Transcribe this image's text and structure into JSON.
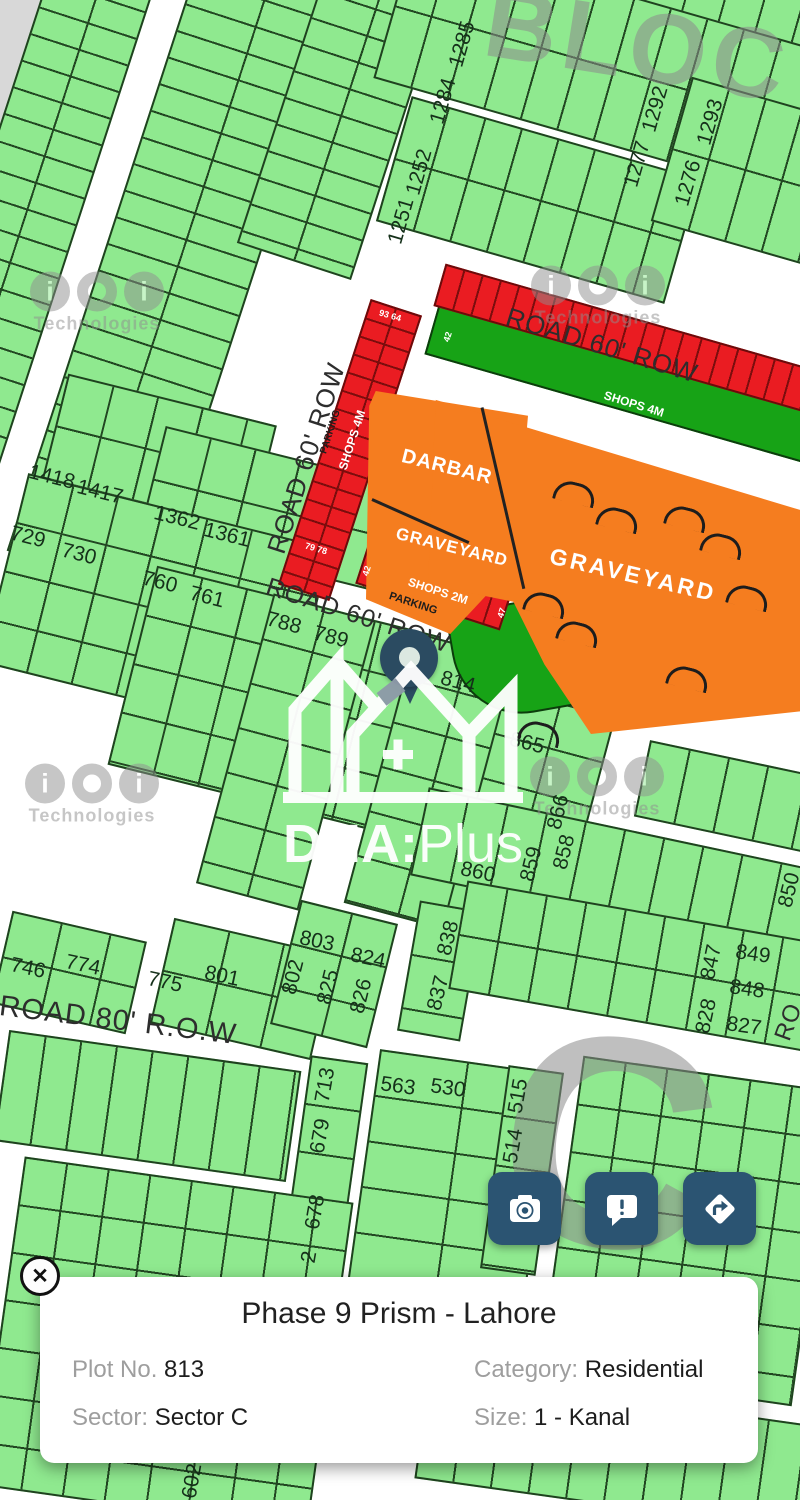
{
  "map": {
    "plots": [
      {
        "t": "1284",
        "x": 443,
        "y": 101,
        "r": -74
      },
      {
        "t": "1285",
        "x": 462,
        "y": 44,
        "r": -74
      },
      {
        "t": "1292",
        "x": 655,
        "y": 109,
        "r": -74
      },
      {
        "t": "1293",
        "x": 710,
        "y": 122,
        "r": -74
      },
      {
        "t": "1251",
        "x": 401,
        "y": 221,
        "r": -74
      },
      {
        "t": "1252",
        "x": 419,
        "y": 172,
        "r": -74
      },
      {
        "t": "1277",
        "x": 637,
        "y": 164,
        "r": -74
      },
      {
        "t": "1276",
        "x": 688,
        "y": 183,
        "r": -74
      },
      {
        "t": "1418",
        "x": 52,
        "y": 477,
        "r": 14
      },
      {
        "t": "1417",
        "x": 100,
        "y": 492,
        "r": 14
      },
      {
        "t": "1362",
        "x": 177,
        "y": 518,
        "r": 14
      },
      {
        "t": "1361",
        "x": 227,
        "y": 535,
        "r": 14
      },
      {
        "t": "729",
        "x": 28,
        "y": 537,
        "r": 14
      },
      {
        "t": "730",
        "x": 79,
        "y": 554,
        "r": 14
      },
      {
        "t": "760",
        "x": 160,
        "y": 582,
        "r": 14
      },
      {
        "t": "761",
        "x": 207,
        "y": 597,
        "r": 14
      },
      {
        "t": "788",
        "x": 284,
        "y": 623,
        "r": 15
      },
      {
        "t": "789",
        "x": 331,
        "y": 637,
        "r": 15
      },
      {
        "t": "813",
        "x": 404,
        "y": 668,
        "r": 15
      },
      {
        "t": "814",
        "x": 458,
        "y": 682,
        "r": 15
      },
      {
        "t": "865",
        "x": 527,
        "y": 743,
        "r": 14
      },
      {
        "t": "866",
        "x": 558,
        "y": 812,
        "r": -76
      },
      {
        "t": "860",
        "x": 478,
        "y": 872,
        "r": 12
      },
      {
        "t": "859",
        "x": 531,
        "y": 864,
        "r": -76
      },
      {
        "t": "858",
        "x": 564,
        "y": 852,
        "r": -76
      },
      {
        "t": "850",
        "x": 789,
        "y": 890,
        "r": -76
      },
      {
        "t": "838",
        "x": 448,
        "y": 938,
        "r": -76
      },
      {
        "t": "837",
        "x": 438,
        "y": 993,
        "r": -76
      },
      {
        "t": "803",
        "x": 317,
        "y": 941,
        "r": 12
      },
      {
        "t": "824",
        "x": 368,
        "y": 958,
        "r": 12
      },
      {
        "t": "802",
        "x": 293,
        "y": 977,
        "r": -76
      },
      {
        "t": "825",
        "x": 328,
        "y": 987,
        "r": -76
      },
      {
        "t": "826",
        "x": 361,
        "y": 996,
        "r": -76
      },
      {
        "t": "746",
        "x": 28,
        "y": 968,
        "r": 12
      },
      {
        "t": "774",
        "x": 83,
        "y": 965,
        "r": 12
      },
      {
        "t": "775",
        "x": 165,
        "y": 982,
        "r": 12
      },
      {
        "t": "801",
        "x": 222,
        "y": 976,
        "r": 12
      },
      {
        "t": "847",
        "x": 711,
        "y": 962,
        "r": -78
      },
      {
        "t": "849",
        "x": 753,
        "y": 954,
        "r": 8
      },
      {
        "t": "848",
        "x": 747,
        "y": 989,
        "r": 8
      },
      {
        "t": "828",
        "x": 706,
        "y": 1016,
        "r": -78
      },
      {
        "t": "827",
        "x": 744,
        "y": 1026,
        "r": 8
      },
      {
        "t": "713",
        "x": 325,
        "y": 1085,
        "r": -80
      },
      {
        "t": "679",
        "x": 320,
        "y": 1136,
        "r": -80
      },
      {
        "t": "563",
        "x": 398,
        "y": 1086,
        "r": 8
      },
      {
        "t": "530",
        "x": 448,
        "y": 1088,
        "r": 8
      },
      {
        "t": "515",
        "x": 518,
        "y": 1096,
        "r": -80
      },
      {
        "t": "514",
        "x": 513,
        "y": 1146,
        "r": -80
      },
      {
        "t": "678",
        "x": 315,
        "y": 1212,
        "r": -80
      },
      {
        "t": "2",
        "x": 309,
        "y": 1257,
        "r": -80
      },
      {
        "t": "602",
        "x": 192,
        "y": 1481,
        "r": -80
      }
    ],
    "roads": [
      {
        "t": "ROAD 60' ROW",
        "x": 602,
        "y": 345,
        "r": 17,
        "s": 26
      },
      {
        "t": "ROAD 60' ROW",
        "x": 306,
        "y": 458,
        "r": -72,
        "s": 26
      },
      {
        "t": "ROAD 60' ROW",
        "x": 358,
        "y": 616,
        "r": 18,
        "s": 25
      },
      {
        "t": "ROAD 80' R.O.W",
        "x": 118,
        "y": 1021,
        "r": 7,
        "s": 29
      },
      {
        "t": "RO",
        "x": 789,
        "y": 1022,
        "r": -70,
        "s": 24
      }
    ],
    "areas": [
      {
        "t": "DARBAR",
        "x": 447,
        "y": 467,
        "r": 14,
        "s": 20,
        "ls": 1
      },
      {
        "t": "GRAVEYARD",
        "x": 452,
        "y": 547,
        "r": 14,
        "s": 17,
        "ls": 1
      },
      {
        "t": "GRAVEYARD",
        "x": 633,
        "y": 575,
        "r": 13,
        "s": 23,
        "ls": 3
      }
    ],
    "shop_labels": [
      {
        "t": "SHOPS 4M",
        "x": 352,
        "y": 440,
        "r": -72,
        "s": 12
      },
      {
        "t": "SHOPS 4M",
        "x": 634,
        "y": 404,
        "r": 17,
        "s": 12
      },
      {
        "t": "SHOPS 2M",
        "x": 438,
        "y": 591,
        "r": 18,
        "s": 12
      }
    ],
    "parking_labels": [
      {
        "t": "PARKING",
        "x": 331,
        "y": 432,
        "r": -72,
        "s": 10
      },
      {
        "t": "PARKING",
        "x": 413,
        "y": 604,
        "r": 18,
        "s": 11
      }
    ],
    "corner_numbers": [
      {
        "t": "93 64",
        "x": 390,
        "y": 316,
        "r": 16,
        "s": 9
      },
      {
        "t": "79 78",
        "x": 316,
        "y": 549,
        "r": 16,
        "s": 9
      },
      {
        "t": "42",
        "x": 448,
        "y": 337,
        "r": -72,
        "s": 9
      },
      {
        "t": "42",
        "x": 367,
        "y": 571,
        "r": -72,
        "s": 9
      },
      {
        "t": "47",
        "x": 502,
        "y": 613,
        "r": -72,
        "s": 9
      }
    ],
    "big_watermarks": [
      {
        "t": "BLOC",
        "x": 638,
        "y": 45,
        "r": 9,
        "s": 100
      },
      {
        "t": "C",
        "x": 612,
        "y": 1142,
        "r": 8,
        "s": 300
      }
    ],
    "brand_watermark": {
      "letters": [
        "i",
        "o",
        "i"
      ],
      "caption": "Technologies",
      "spots": [
        {
          "x": 97,
          "y": 303
        },
        {
          "x": 598,
          "y": 297
        },
        {
          "x": 92,
          "y": 795
        },
        {
          "x": 597,
          "y": 788
        }
      ]
    },
    "graveyard_arcs": [
      [
        575,
        493
      ],
      [
        618,
        519
      ],
      [
        686,
        518
      ],
      [
        722,
        545
      ],
      [
        545,
        604
      ],
      [
        578,
        633
      ],
      [
        688,
        678
      ],
      [
        748,
        597
      ],
      [
        540,
        733
      ]
    ]
  },
  "logo": {
    "bold": "DHA",
    "sep": ":",
    "light": "Plus"
  },
  "pin": {
    "plot": "813"
  },
  "buttons": [
    {
      "icon": "camera-icon"
    },
    {
      "icon": "report-icon"
    },
    {
      "icon": "directions-icon"
    }
  ],
  "card": {
    "title": "Phase 9 Prism - Lahore",
    "plot_label": "Plot No. ",
    "plot_value": "813",
    "category_label": "Category: ",
    "category_value": "Residential",
    "sector_label": "Sector: ",
    "sector_value": "Sector C",
    "size_label": "Size: ",
    "size_value": "1 - Kanal"
  },
  "close_glyph": "✕",
  "colors": {
    "accent": "#2b5472",
    "plot_green": "#8fe98f",
    "dark_green": "#17a316",
    "graveyard_orange": "#f57d1f",
    "shop_red": "#ea1c22",
    "pin": "#2b4b61"
  }
}
